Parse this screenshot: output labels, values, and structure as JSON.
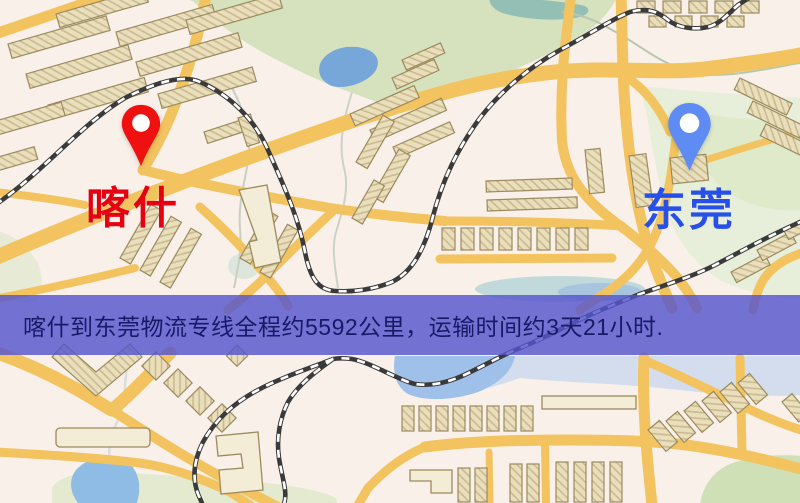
{
  "map": {
    "origin": {
      "label": "喀什"
    },
    "destination": {
      "label": "东莞"
    },
    "banner": {
      "text": "喀什到东莞物流专线全程约5592公里，运输时间约3天21小时."
    },
    "colors": {
      "origin_pin": "#ef1010",
      "origin_label": "#e60112",
      "destination_pin": "#5e8cf2",
      "destination_label": "#2750e8",
      "banner_bg": "rgba(86,86,205,0.82)",
      "banner_text": "#191968",
      "road": "#f2c35e",
      "park_green": "#d5e2bd",
      "water_blue": "#76a7d8",
      "building_tan": "#eadfbd"
    }
  }
}
